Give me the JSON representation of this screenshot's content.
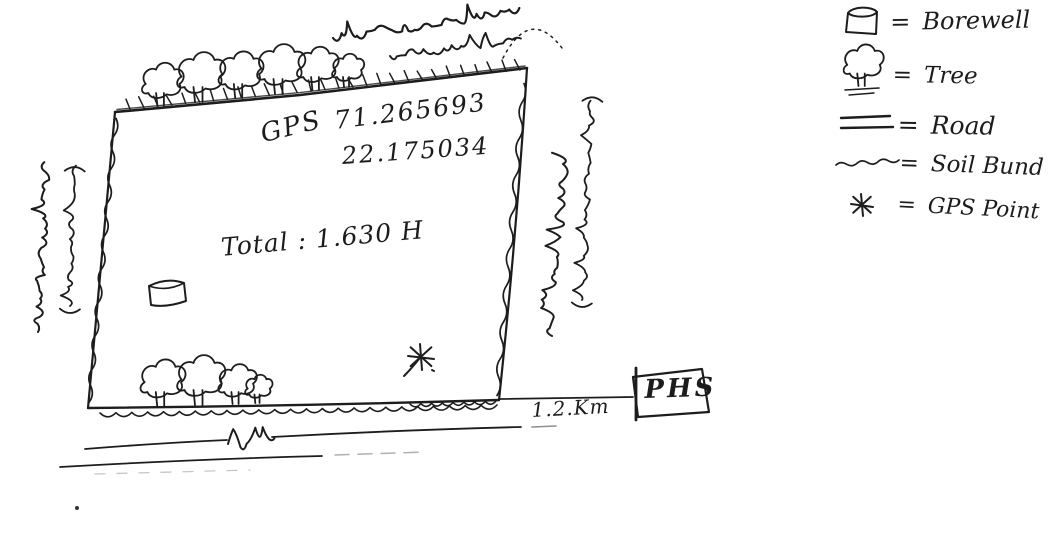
{
  "page": {
    "background": "#ffffff",
    "ink_color": "#1d1d1d"
  },
  "plot": {
    "gps_label": "GPS",
    "gps_longitude": "71.265693",
    "gps_latitude": "22.175034",
    "total_area": "Total : 1.630 H"
  },
  "connector": {
    "distance": "1.2.Km",
    "destination": "PHS"
  },
  "legend": {
    "equals": "=",
    "items": [
      {
        "icon": "borewell-icon",
        "label": "Borewell"
      },
      {
        "icon": "tree-icon",
        "label": "Tree"
      },
      {
        "icon": "road-icon",
        "label": "Road"
      },
      {
        "icon": "soil-bund-icon",
        "label": "Soil Bund"
      },
      {
        "icon": "gps-point-icon",
        "label": "GPS Point"
      }
    ]
  },
  "handwritten_gujarati": {
    "top_label": "ખેડૂતનું ખેતર",
    "top_label_faint": "હયાતભાઈ",
    "left_label": "ખેડૂતનું ખેતર",
    "left_label_name": "(Gamnubhai)",
    "right_label": "ખેડૂતનું ખેતર",
    "right_label_name": "(Velubhai)",
    "road_label": "રસ્તો"
  }
}
